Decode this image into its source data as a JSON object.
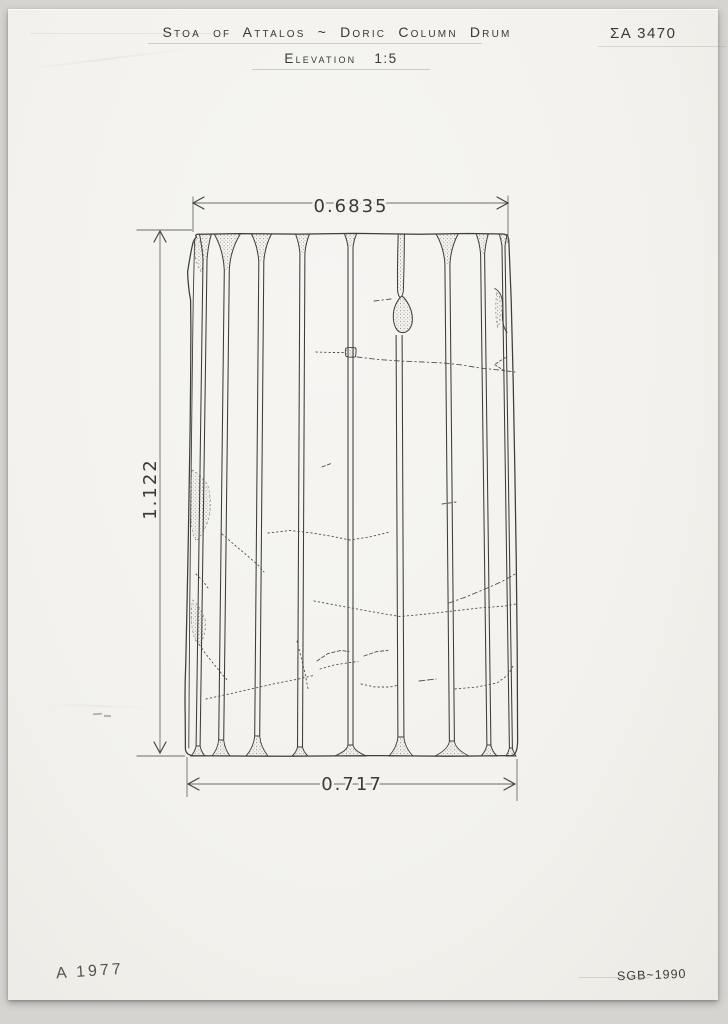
{
  "header": {
    "title": "Stoa of Attalos ~ Doric Column Drum",
    "view_label": "Elevation",
    "scale": "1:5",
    "catalog_number": "ΣA 3470"
  },
  "dimensions": {
    "top_width": "0.6835",
    "bottom_width": "0.717",
    "height": "1.122"
  },
  "footer": {
    "left_note": "A 1977",
    "right_note": "SGB~1990"
  },
  "colors": {
    "ink": "#3f3d39",
    "dim_line": "#6e6c68",
    "crack": "#52504b",
    "paper": "#f3f2ee",
    "background": "#d5d4d1"
  },
  "drawing": {
    "subject": "doric-column-drum-elevation",
    "ink": "#3f3d39",
    "canvas": {
      "cx": 351,
      "top_y": 234,
      "bottom_y": 756,
      "taper": 0.9518
    },
    "paths": [
      {
        "d": "M196.5,237 Q194.5,234.6 198,234.2 L240,233.6 L300,234.1 L355,233.4 L420,234.2 L468,233.5 L502.5,234 Q508.3,234 508.8,240 L511.2,300 L513.2,382 L514.8,468 L516.2,556 L517.2,648 L517.6,740 Q517.7,755.4 511,755.6 L448,756.2 L372,755.6 L287,756.3 L196,755.8 Q185.2,756 185.4,748 L185.2,716 Q184.6,690 185.8,662 L187.2,596 L188.4,534 L189.3,478 L190.1,430 L190.6,382 L190.9,330 L190.6,300 Q188.2,288 187.6,272 Q189.7,258 192.2,246 Q193.4,239.5 196.5,237 Z",
        "w": 1.25
      },
      {
        "d": "M194.6,241 L193.2,300 L192.3,370 L191.5,440 L190.6,520 L189.8,600 L189.2,680 L188.8,748",
        "w": 0.9
      },
      {
        "d": "M398.2,234.5 C397.6,254 397.2,274 397.6,291 L403.4,289.5 C404,271 404.3,252 404.4,234.5 Z",
        "f": "url(#stip)",
        "s": ""
      },
      {
        "d": "M398.2,234.5 C397.6,254 397.2,274 397.6,291 Q398.4,296.5 400.2,297.5",
        "w": 1
      },
      {
        "d": "M404.4,234.5 C404.3,252 404,271 403.4,289.5 Q403.2,294 401.8,296",
        "w": 1
      },
      {
        "d": "M400.2,297.5 C396,302.5 393,309.5 393.3,317.5 C393.6,326.5 397.2,332.3 402.2,332.6 C407.8,332.9 412.3,327.5 412.4,319.5 C412.5,311 408.8,303.5 403.8,297.5 Q401.8,295.2 400.2,297.5 Z",
        "f": "url(#stip)",
        "w": 1
      },
      {
        "d": "M494.8,288.5 Q504,293.5 502.6,311 Q501.4,325 507,332.5",
        "w": 0.95
      },
      {
        "d": "M345.8,348.2 Q344.8,352.8 346,356.4 Q350.6,357.8 355.4,356.8 Q356.6,352 355.8,348 Q350.6,346.8 345.8,348.2 Z",
        "f": "url(#stip)",
        "w": 0.9
      }
    ],
    "patches": [
      {
        "d": "M196.5,237.5 Q201.5,240.5 203.2,252 Q203.8,262 201.5,272 Q196.2,266 194.6,252 Q195,242 196.5,237.5 Z"
      },
      {
        "d": "M192,470 Q200,473.5 207.5,484.5 Q212,499 209.5,516 Q205.5,531 196.5,541 Q191.5,536 190.7,512 Q190.3,488 192,470 Z"
      },
      {
        "d": "M192.6,600 Q201,607 205.5,621 Q206.5,634 199.5,645 Q192.9,641 191.3,620 Q191.1,608 192.6,600 Z"
      },
      {
        "d": "M496.5,292.5 Q502,295.5 501.2,311.5 Q499.9,324 497.7,327.5 Q495.4,318 495.8,304 Z"
      }
    ],
    "arris": [
      {
        "xb": 198,
        "gap": 4,
        "nd": 26,
        "ns": 6,
        "fd": 10,
        "fs": 7
      },
      {
        "xb": 221,
        "gap": 5,
        "nd": 36,
        "ns": 13,
        "fd": 16,
        "fs": 9
      },
      {
        "xb": 257,
        "gap": 5,
        "nd": 28,
        "ns": 10,
        "fd": 20,
        "fs": 11
      },
      {
        "xb": 300,
        "gap": 5,
        "nd": 19,
        "ns": 7,
        "fd": 9,
        "fs": 8
      },
      {
        "xb": 350.5,
        "gap": 5,
        "nd": 13,
        "ns": 6,
        "fd": 11,
        "fs": 16
      },
      {
        "xb": 401,
        "gap": 6,
        "nd": 101,
        "nf": true,
        "fd": 19,
        "fs": 12
      },
      {
        "xb": 452,
        "gap": 5,
        "nd": 30,
        "ns": 11,
        "fd": 15,
        "fs": 17
      },
      {
        "xb": 489,
        "gap": 4,
        "nd": 20,
        "ns": 6,
        "fd": 11,
        "fs": 8
      },
      {
        "xb": 511,
        "gap": 3,
        "nd": 12,
        "ns": 4,
        "fd": 8,
        "fs": 5
      }
    ],
    "cracks": [
      {
        "pts": [
          [
            374,
            301
          ],
          [
            391,
            299
          ]
        ],
        "dash": "5 3 1.5 3"
      },
      {
        "pts": [
          [
            316,
            352
          ],
          [
            331,
            352.5
          ],
          [
            344,
            352.5
          ]
        ],
        "dash": "1.5 2.8"
      },
      {
        "pts": [
          [
            357,
            357
          ],
          [
            378,
            359.5
          ],
          [
            400,
            361
          ],
          [
            423,
            362
          ],
          [
            444,
            363
          ],
          [
            462,
            365
          ],
          [
            480,
            368
          ],
          [
            499,
            370
          ],
          [
            515,
            372
          ]
        ],
        "dash": "5 3 1.5 3"
      },
      {
        "pts": [
          [
            505.5,
            357.5
          ],
          [
            494.5,
            364.5
          ],
          [
            505.5,
            371.5
          ]
        ],
        "dash": "2.5 2"
      },
      {
        "pts": [
          [
            449,
            603
          ],
          [
            467,
            596.5
          ],
          [
            485,
            589
          ],
          [
            502,
            581.5
          ],
          [
            517,
            573
          ]
        ],
        "dash": "5 3 1.5 3"
      },
      {
        "pts": [
          [
            268,
            533
          ],
          [
            290,
            530.5
          ],
          [
            312,
            533
          ],
          [
            333,
            536.5
          ],
          [
            350,
            540
          ],
          [
            369,
            537
          ],
          [
            390,
            532
          ]
        ],
        "dash": "1.5 2.8"
      },
      {
        "pts": [
          [
            314,
            601
          ],
          [
            346,
            607
          ],
          [
            379,
            613
          ],
          [
            400,
            616.5
          ],
          [
            427,
            614
          ],
          [
            453,
            611
          ],
          [
            479,
            608
          ],
          [
            505,
            606
          ],
          [
            516,
            604
          ]
        ],
        "dash": "1.5 2.8"
      },
      {
        "pts": [
          [
            222,
            534
          ],
          [
            237,
            547
          ],
          [
            250,
            558
          ],
          [
            259,
            566
          ],
          [
            264,
            572
          ]
        ],
        "dash": "1.5 2.8"
      },
      {
        "pts": [
          [
            196,
            574
          ],
          [
            203,
            581
          ],
          [
            208,
            588
          ]
        ],
        "dash": "1.5 2.8"
      },
      {
        "pts": [
          [
            197,
            641
          ],
          [
            205,
            653
          ],
          [
            213,
            663
          ],
          [
            221,
            673
          ],
          [
            228,
            681
          ]
        ],
        "dash": "1.5 2.8"
      },
      {
        "pts": [
          [
            206,
            699
          ],
          [
            229,
            694
          ],
          [
            253,
            688.5
          ],
          [
            278,
            683
          ],
          [
            301,
            678.5
          ],
          [
            313,
            675.5
          ]
        ],
        "dash": "1.5 2.8"
      },
      {
        "pts": [
          [
            297,
            641
          ],
          [
            301,
            657
          ],
          [
            305,
            673
          ],
          [
            308,
            689
          ]
        ],
        "dash": "1.5 2.8"
      },
      {
        "pts": [
          [
            317,
            661
          ],
          [
            328,
            653.5
          ],
          [
            341,
            650.5
          ],
          [
            349,
            651.5
          ]
        ],
        "dash": "3.5 2.2"
      },
      {
        "pts": [
          [
            320,
            669
          ],
          [
            334,
            665
          ],
          [
            350,
            662.5
          ],
          [
            358,
            661.5
          ]
        ],
        "dash": "1.5 2.8"
      },
      {
        "pts": [
          [
            364,
            656
          ],
          [
            377,
            651.5
          ],
          [
            388,
            650.5
          ]
        ],
        "dash": "3.5 2.2"
      },
      {
        "pts": [
          [
            361,
            684
          ],
          [
            375,
            687
          ],
          [
            390,
            687
          ],
          [
            399,
            685
          ]
        ],
        "dash": "1.5 2.8"
      },
      {
        "pts": [
          [
            419,
            681
          ],
          [
            436,
            679
          ]
        ],
        "dash": "6 2.5"
      },
      {
        "pts": [
          [
            455,
            689
          ],
          [
            477,
            687
          ],
          [
            497,
            683
          ],
          [
            508,
            675
          ],
          [
            513,
            666
          ]
        ],
        "dash": "1.5 2.8"
      },
      {
        "pts": [
          [
            322,
            467
          ],
          [
            331,
            463.5
          ]
        ],
        "dash": "3.5 2.2"
      },
      {
        "pts": [
          [
            442,
            504
          ],
          [
            456,
            502
          ]
        ],
        "dash": "4 2.2"
      }
    ],
    "dims": {
      "lines": [
        [
          193,
          203,
          508,
          203
        ],
        [
          193,
          196.5,
          193,
          232
        ],
        [
          508,
          195.5,
          508,
          243
        ],
        [
          160,
          231,
          160,
          753
        ],
        [
          136.5,
          230,
          192,
          230
        ],
        [
          136.5,
          756,
          185,
          756
        ],
        [
          188,
          784,
          515,
          784
        ],
        [
          187,
          757,
          187,
          797
        ],
        [
          517,
          759,
          517,
          801
        ]
      ],
      "chevrons": [
        [
          193,
          203,
          "r"
        ],
        [
          508,
          203,
          "l"
        ],
        [
          160,
          231,
          "d"
        ],
        [
          160,
          753,
          "u"
        ],
        [
          188,
          784,
          "r"
        ],
        [
          515,
          784,
          "l"
        ]
      ]
    }
  }
}
